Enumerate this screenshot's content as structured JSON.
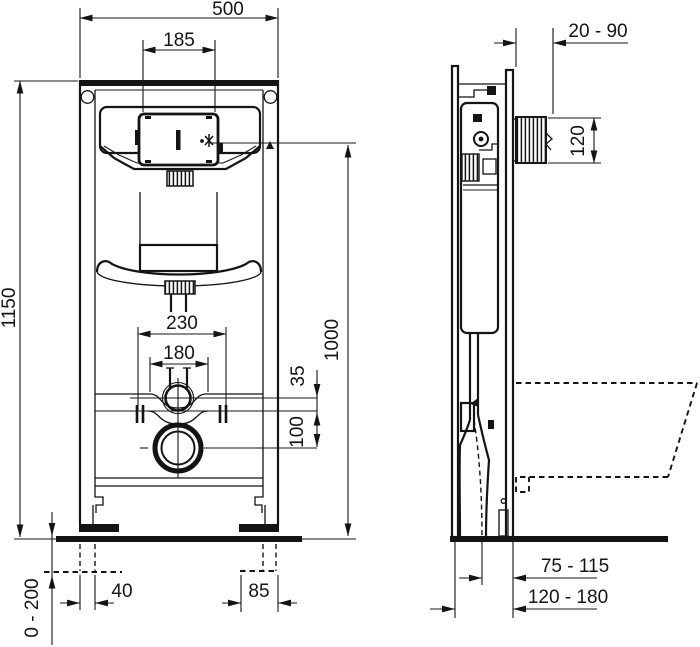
{
  "drawing": {
    "subject": "Concealed cistern WC installation frame - front and side view technical drawing",
    "units": "mm",
    "line_color": "#141414",
    "background_color": "#ffffff",
    "front_view": {
      "frame_width": "500",
      "flush_plate_opening_width": "185",
      "frame_height": "1150",
      "fixing_span_outer": "230",
      "fixing_span_inner": "180",
      "inlet_to_rail_offset": "35",
      "rail_to_outlet_offset": "100",
      "flush_plate_center_height": "1000",
      "left_foot_width": "40",
      "right_foot_width": "85",
      "leg_adjustment_range": "0 - 200"
    },
    "side_view": {
      "wall_finish_range": "20 - 90",
      "flush_opening_height": "120",
      "outlet_center_to_front": "75 - 115",
      "frame_depth_range": "120 - 180"
    }
  }
}
